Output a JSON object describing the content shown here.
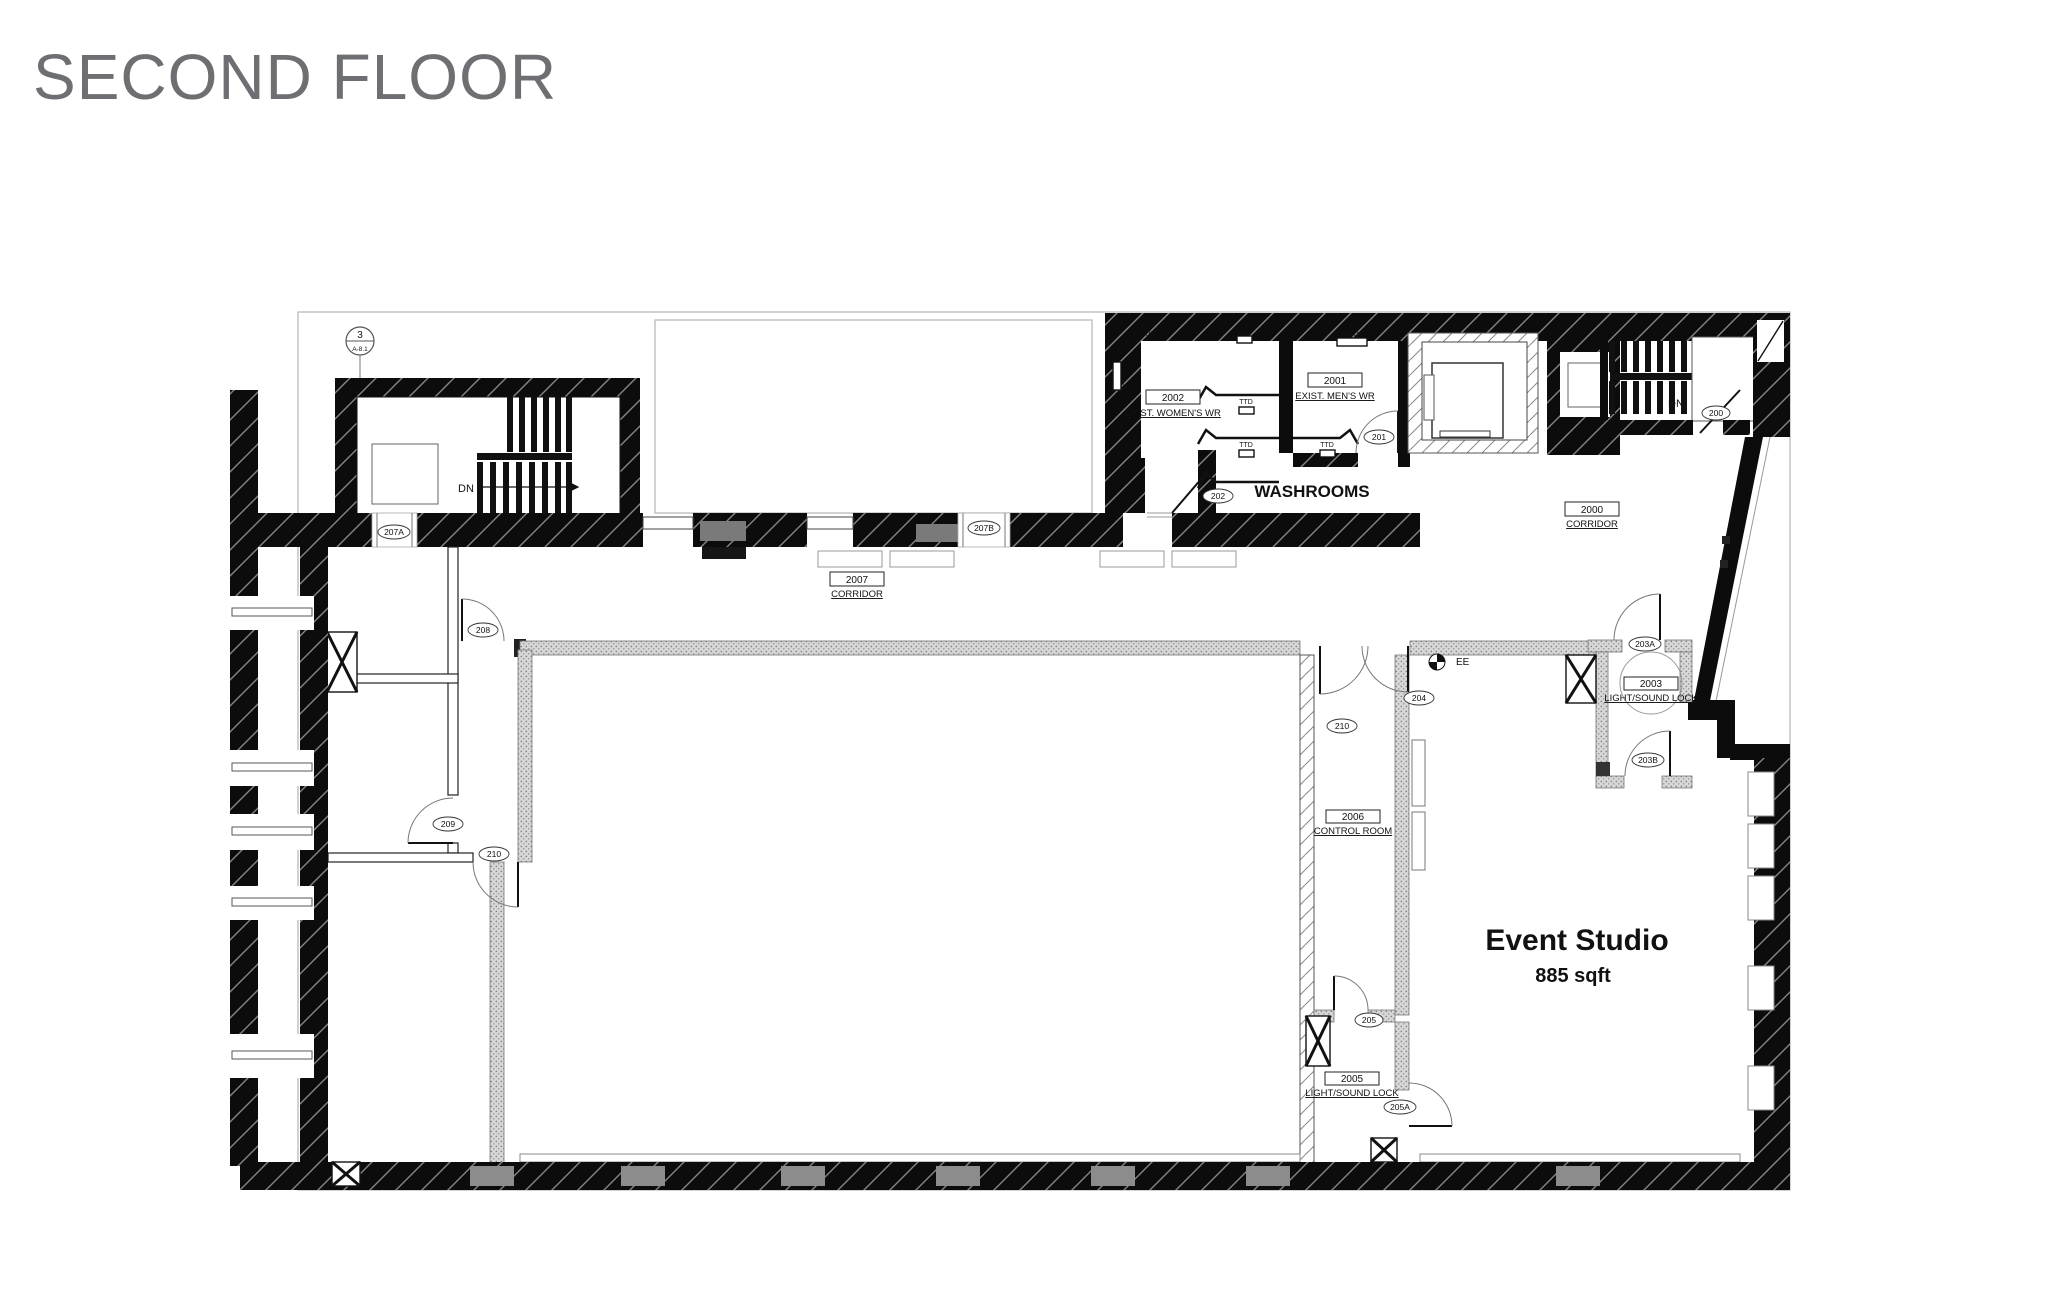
{
  "title": "SECOND FLOOR",
  "plan": {
    "section_marker": {
      "number": "3",
      "sheet": "A-8.1"
    },
    "rooms": {
      "womens": {
        "number": "2002",
        "name": "EXIST. WOMEN'S WR"
      },
      "mens": {
        "number": "2001",
        "name": "EXIST. MEN'S WR"
      },
      "corridor2007": {
        "number": "2007",
        "name": "CORRIDOR"
      },
      "corridor2000": {
        "number": "2000",
        "name": "CORRIDOR"
      },
      "lock2003": {
        "number": "2003",
        "name": "LIGHT/SOUND LOCK"
      },
      "control": {
        "number": "2006",
        "name": "CONTROL ROOM"
      },
      "lock2005": {
        "number": "2005",
        "name": "LIGHT/SOUND LOCK"
      }
    },
    "areas": {
      "washrooms": "WASHROOMS",
      "event_studio": {
        "name": "Event Studio",
        "area": "885 sqft"
      }
    },
    "doors": {
      "d200": "200",
      "d201": "201",
      "d202": "202",
      "d203a": "203A",
      "d203b": "203B",
      "d204": "204",
      "d205": "205",
      "d205a": "205A",
      "d207a": "207A",
      "d207b": "207B",
      "d208": "208",
      "d209": "209",
      "d210": "210",
      "d210cr": "210"
    },
    "stairs": {
      "dn": "DN"
    },
    "fixtures": {
      "sd": "SD",
      "ttd": "TTD",
      "towr": "TOWR",
      "ee": "EE"
    },
    "colors": {
      "title": "#6e6f72",
      "wall": "#0c0c0c",
      "accent_gray": "#8c8c8c"
    }
  }
}
